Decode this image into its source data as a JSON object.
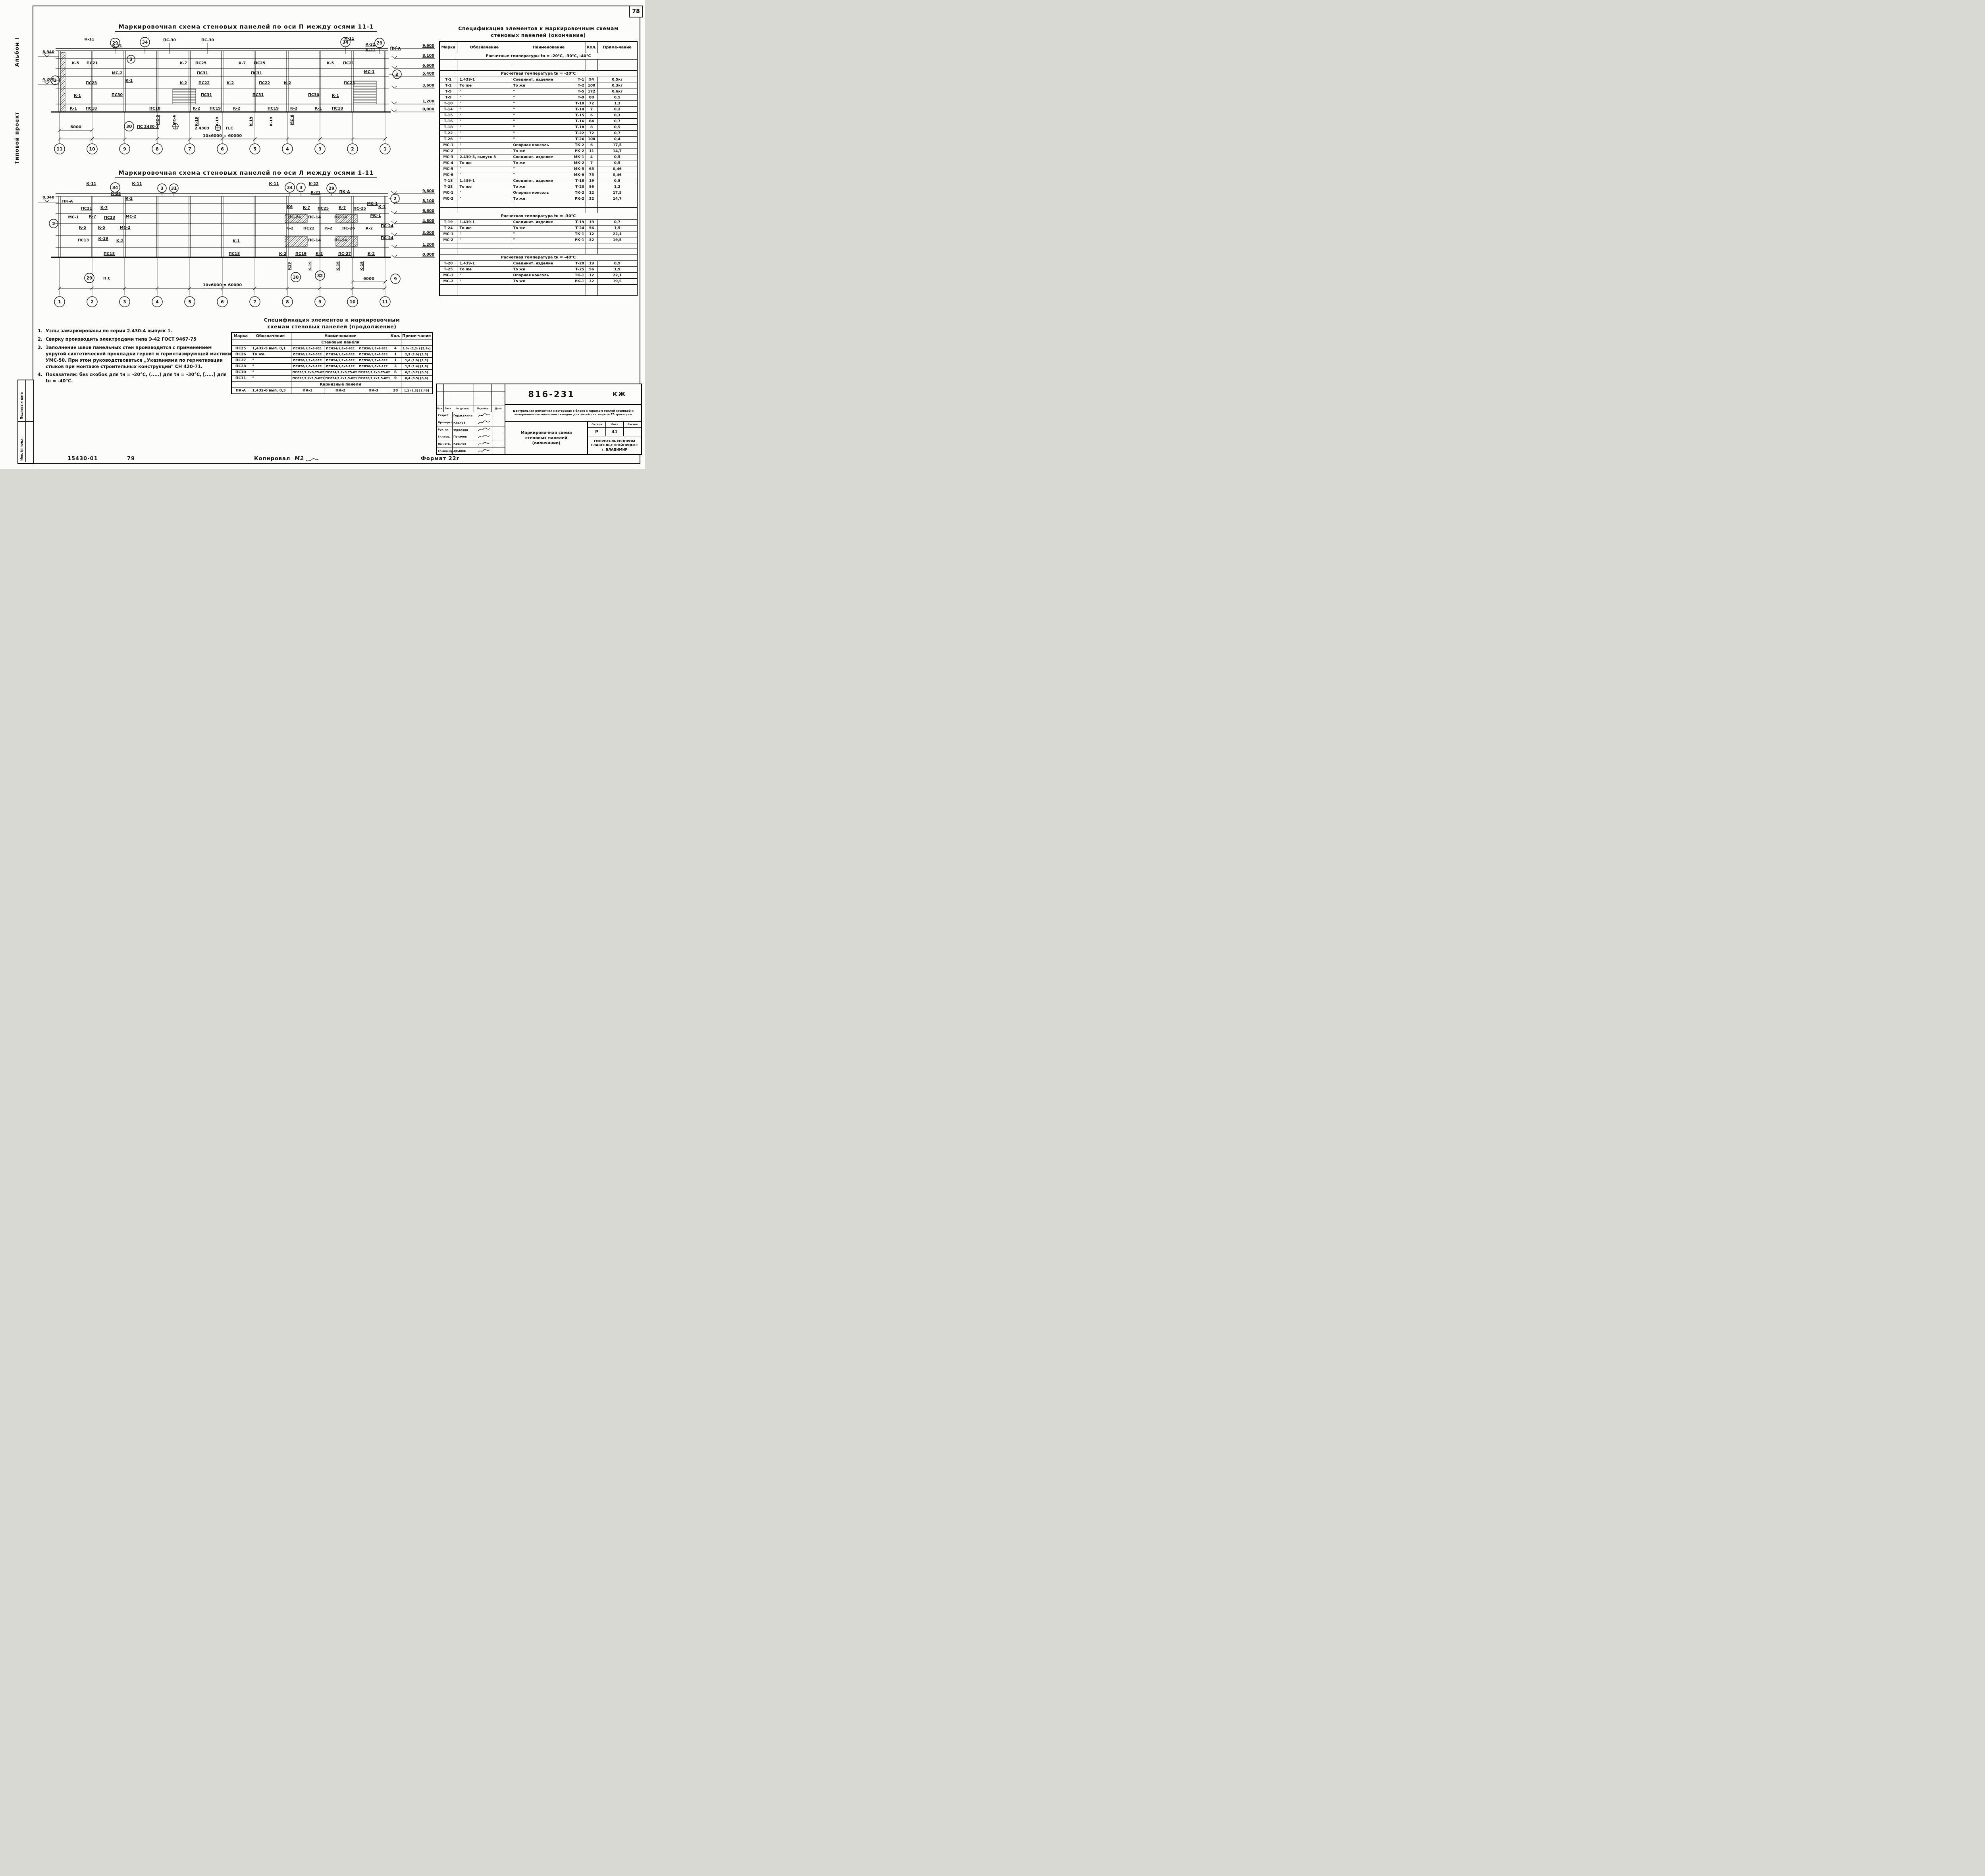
{
  "page": {
    "num": "78",
    "album": "Альбом I",
    "tip": "Типовой проект",
    "strip_top": "Подпись и дата",
    "strip_bot": "Инв. № подл.",
    "f_num": "15430-01",
    "f_num2": "79",
    "f_copy": "Копировал",
    "f_copy_sig": "М2",
    "f_format": "Формат 22г"
  },
  "drawing_top": {
    "title": "Маркировочная схема стеновых панелей по оси П между осями 11-1",
    "axes": [
      "11",
      "10",
      "9",
      "8",
      "7",
      "6",
      "5",
      "4",
      "3",
      "2",
      "1"
    ],
    "elevs": [
      "9,600",
      "8,100",
      "6,600",
      "5,400",
      "3,600",
      "1,200",
      "0,000"
    ],
    "elev_left": [
      "8,340",
      "4,200"
    ],
    "callouts": {
      "c29l": "29",
      "c34l": "34",
      "c3": "3",
      "c34r": "34",
      "c29r": "29",
      "c2l": "2",
      "c2r": "2"
    },
    "diag_left": [
      "К-11",
      "К-21"
    ],
    "diag_right": [
      "К-11",
      "К-22",
      "К-21",
      "ПК-А"
    ],
    "ps30": [
      "ПС-30",
      "ПС-30"
    ],
    "rowA": [
      "К-5",
      "ПС21",
      "К-7",
      "ПС25",
      "К-7",
      "ПС25",
      "К-5",
      "ПС21"
    ],
    "rowB": [
      "МС-2",
      "ПС31",
      "ПС31",
      "МС-1"
    ],
    "rowC": [
      "ПС23",
      "К-1",
      "К-2",
      "ПС22",
      "К-2",
      "ПС22",
      "К-2",
      "ПС23"
    ],
    "rowD": [
      "К-1",
      "ПС30",
      "ПС31",
      "ПС31",
      "ПС30",
      "К-1"
    ],
    "rowE": [
      "К-1",
      "ПС18",
      "ПС18",
      "К-2",
      "ПС19",
      "К-2",
      "ПС19",
      "К-2",
      "К-1",
      "ПС18"
    ],
    "rot": [
      "МС-5",
      "МС-6",
      "МС-6",
      "К-19",
      "К-19",
      "К-19",
      "К-19"
    ],
    "det30": "30",
    "det_ps": "ПС 2430-3",
    "det_ps2": "2.4303",
    "det_pc": "П.С",
    "dim_bay": "6000",
    "dim_total": "10х6000 = 60000"
  },
  "drawing_mid": {
    "title": "Маркировочная схема стеновых панелей по оси Л между осями 1-11",
    "axes": [
      "1",
      "2",
      "3",
      "4",
      "5",
      "6",
      "7",
      "8",
      "9",
      "10",
      "11"
    ],
    "elevs": [
      "9,600",
      "8,100",
      "6,600",
      "4,800",
      "3,000",
      "1,200",
      "0,000"
    ],
    "elev_left": [
      "8,340"
    ],
    "callouts": {
      "c34l": "34",
      "c3l": "3",
      "c31": "31",
      "c34r": "34",
      "c3r": "3",
      "c29r": "29",
      "c2l": "2",
      "c2r": "2"
    },
    "diag_left": [
      "К-11",
      "К-22",
      "К-2",
      "ПК-А",
      "К-11"
    ],
    "diag_right": [
      "К-11",
      "К-22",
      "К-21",
      "ПК-А",
      "МС-1"
    ],
    "rowA": [
      "ПС21",
      "К-7",
      "К6",
      "К-7",
      "ПС25",
      "К-7",
      "ПС-25",
      "К-1"
    ],
    "rowB": [
      "МС-1",
      "К-7",
      "ПС23",
      "МС-2",
      "ПС-24",
      "ПС-14",
      "ПС-14",
      "МС-1"
    ],
    "rowC": [
      "К-5",
      "К-5",
      "МС-2",
      "К-2",
      "ПС22",
      "К-2",
      "ПС-26",
      "К-2",
      "ПС-24"
    ],
    "rowD": [
      "ПС13",
      "К-19",
      "К-2",
      "К-1",
      "ПС-14",
      "ПС-14",
      "ПС-24"
    ],
    "rowE": [
      "ПС18",
      "ПС18",
      "К-2",
      "ПС19",
      "К-2",
      "ПС-27",
      "К-2"
    ],
    "rot": [
      "К19",
      "К-19",
      "К-19",
      "К-19"
    ],
    "det": {
      "d29": "29",
      "dpc": "П.С",
      "d30": "30",
      "d32": "32",
      "d9": "9"
    },
    "dim_bay": "6000",
    "dim_total": "10х6000 = 60000"
  },
  "notes": [
    {
      "n": "1.",
      "t": "Узлы замаркированы по серии 2.430-4 выпуск 1."
    },
    {
      "n": "2.",
      "t": "Сварку производить электродами типа Э-42 ГОСТ 9467-75"
    },
    {
      "n": "3.",
      "t": "Заполнение швов панельных стен производится с применением упругой синтетической прокладки гернит и герметизирующей мастики УМС-50. При этом руководствоваться „Указаниями по герметизации стыков при монтаже строительных конструкций\" СН 420-71."
    },
    {
      "n": "4.",
      "t": "Показатели: без скобок для tн = -20°С, (.....) для tн = -30°С, [.....] для tн = -40°С."
    }
  ],
  "spec_bottom": {
    "title1": "Спецификация элементов к маркировочным",
    "title2": "схемам стеновых панелей (продолжение)",
    "h": [
      "Марка",
      "Обозначение",
      "Наименование",
      "Кол.",
      "Приме-чание"
    ],
    "secA": {
      "title": "Стеновые панели",
      "rows": [
        [
          "ПС25",
          "1,432-5 вып. 0,1",
          "ПСЛ20/1,5х6-621",
          "ПСЛ24/1,5х6-621",
          "ПСЛ30/1,5х6-621",
          "4",
          "2,0т (2,2т) [2,9т]"
        ],
        [
          "ПС26",
          "То же",
          "ПСЛ20/1,8х6-322",
          "ПСЛ24/1,8х6-322",
          "ПСЛ30/1,8х6-322",
          "1",
          "2,5 (2,9) [3,5]"
        ],
        [
          "ПС27",
          "\"",
          "ПСЛ20/1,2х6-322",
          "ПСЛ24/1,2х6-322",
          "ПСП30/1,2х6-322",
          "1",
          "1,6 (1,9) [2,3]"
        ],
        [
          "ПС28",
          "\"",
          "ПСЛ20/1,8х3-122",
          "ПСЛ24/1,8х3-122",
          "ПСЛ30/1,8х3-122",
          "3",
          "1,5 (1,4) [1,8]"
        ],
        [
          "ПС30",
          "\"",
          "ПСЛ20/1,2х0,75-022",
          "ПСЛ24/1,2х0,75-022",
          "ПСЛ30/1,2х0,75-022",
          "6",
          "0,2 (0,2) [0,3]"
        ],
        [
          "ПС31",
          "\"",
          "ПСЛ20/1,2х1,5-021",
          "ПСЛ24/1,2х1,5-021",
          "ПСЛ30/1,2х1,5-021",
          "9",
          "0,4 (0,5) [0,6]"
        ]
      ]
    },
    "secB": {
      "title": "Карнизные панели",
      "rows": [
        [
          "ПК-А",
          "1.432-6 вып. 0,3",
          "ПК-1",
          "ПК-2",
          "ПК-3",
          "28",
          "1,2 (1,3) [1,45]"
        ]
      ]
    }
  },
  "spec_right": {
    "title1": "Спецификация элементов к маркировочным схемам",
    "title2": "стеновых панелей (окончание)",
    "h": [
      "Марка",
      "Обозначение",
      "Наименование",
      "Кол.",
      "Приме-чание"
    ],
    "sec1": {
      "title": "Расчетные температуры tн = -20°С, -30°С, -40°С",
      "rows": [
        [
          "Т-1",
          "1.439-1",
          "Соединит. изделие",
          "Т-1",
          "94",
          "0,5кг"
        ],
        [
          "Т-2",
          "То же",
          "То же",
          "Т-2",
          "100",
          "0,3кг"
        ],
        [
          "Т-5",
          "\"",
          "\"",
          "Т-5",
          "172",
          "0,6кг"
        ],
        [
          "Т-9",
          "\"",
          "\"",
          "Т-9",
          "80",
          "0,5"
        ],
        [
          "Т-10",
          "\"",
          "\"",
          "Т-10",
          "72",
          "1,3"
        ],
        [
          "Т-14",
          "\"",
          "\"",
          "Т-14",
          "7",
          "0,2"
        ],
        [
          "Т-15",
          "\"",
          "\"",
          "Т-15",
          "6",
          "0,3"
        ],
        [
          "Т-16",
          "\"",
          "\"",
          "Т-16",
          "84",
          "0,7"
        ],
        [
          "Т-18",
          "\"",
          "\"",
          "Т-18",
          "8",
          "0,5"
        ],
        [
          "Т-22",
          "\"",
          "\"",
          "Т-22",
          "72",
          "0,7"
        ],
        [
          "Т-26",
          "\"",
          "\"",
          "Т-26",
          "108",
          "0,4"
        ],
        [
          "МС-1",
          "\"",
          "Опорная консоль",
          "ТК-2",
          "6",
          "17,5"
        ],
        [
          "МС-2",
          "\"",
          "То же",
          "РК-2",
          "11",
          "14,7"
        ],
        [
          "МС-3",
          "2.430-3, выпуск 3",
          "Соединит. изделие",
          "МК-1",
          "4",
          "0,5"
        ],
        [
          "МС-4",
          "То же",
          "То же",
          "МК-2",
          "7",
          "0,5"
        ],
        [
          "МС-5",
          "\"",
          "\"",
          "МК-5",
          "65",
          "0,46"
        ],
        [
          "МС-6",
          "\"",
          "\"",
          "МК-6",
          "75",
          "0,46"
        ]
      ]
    },
    "sec2": {
      "title": "Расчетная температура tн = -20°С",
      "rows": [
        [
          "Т-18",
          "1.439-1",
          "Соединит. изделие",
          "Т-18",
          "19",
          "0,5"
        ],
        [
          "Т-23",
          "То же",
          "То же",
          "Т-23",
          "56",
          "1,2"
        ],
        [
          "МС-1",
          "\"",
          "Опорная консоль",
          "ТК-2",
          "12",
          "17,5"
        ],
        [
          "МС-2",
          "\"",
          "То же",
          "РК-2",
          "32",
          "14,7"
        ]
      ]
    },
    "sec3": {
      "title": "Расчетная температура tн = -30°С",
      "rows": [
        [
          "Т-19",
          "1.439-1",
          "Соединит. изделие",
          "Т-19",
          "19",
          "0,7"
        ],
        [
          "Т-24",
          "То же",
          "То же",
          "Т-24",
          "56",
          "1,5"
        ],
        [
          "МС-1",
          "\"",
          "\"",
          "ТК-1",
          "12",
          "22,1"
        ],
        [
          "МС-2",
          "\"",
          "\"",
          "РК-1",
          "32",
          "19,5"
        ]
      ]
    },
    "sec4": {
      "title": "Расчетная температура tн = -40°С",
      "rows": [
        [
          "Т-20",
          "1.439-1",
          "Соединит. изделие",
          "Т-20",
          "19",
          "0,9"
        ],
        [
          "Т-25",
          "То же",
          "То же",
          "Т-25",
          "56",
          "1,9"
        ],
        [
          "МС-1",
          "\"",
          "Опорная консоль",
          "ТК-1",
          "12",
          "22,1"
        ],
        [
          "МС-2",
          "\"",
          "То же",
          "РК-1",
          "32",
          "19,5"
        ]
      ]
    }
  },
  "title_block": {
    "docnum": "816-231",
    "code": "КЖ",
    "project": "Центральная ремонтная мастерская в блоке с гаражом теплой стоянкой и материально-техническим складом для хозяйств с парком 75 тракторов",
    "hdr": [
      "Изм.",
      "Лист",
      "№ докум.",
      "Подпись",
      "Дата"
    ],
    "staff": [
      {
        "role": "Разраб.",
        "name": "Гераськина"
      },
      {
        "role": "Проверил",
        "name": "Кислов"
      },
      {
        "role": "Рук. гр.",
        "name": "Фролова"
      },
      {
        "role": "Гл.спец.",
        "name": "Пугачев"
      },
      {
        "role": "Нач.отд.",
        "name": "Крылов"
      },
      {
        "role": "Гл.инж.пр.",
        "name": "Трынов"
      }
    ],
    "litera_h": [
      "Литера",
      "Лист",
      "Листов"
    ],
    "litera_v": [
      "Р",
      "41",
      ""
    ],
    "sheet_t1": "Маркировочная схема",
    "sheet_t2": "стеновых панелей",
    "sheet_t3": "(окончание)",
    "org1": "ГИПРОСЕЛЬХОЗПРОМ",
    "org2": "ГЛАВСЕЛЬСТРОЙПРОЕКТ",
    "org3": "г. ВЛАДИМИР"
  }
}
